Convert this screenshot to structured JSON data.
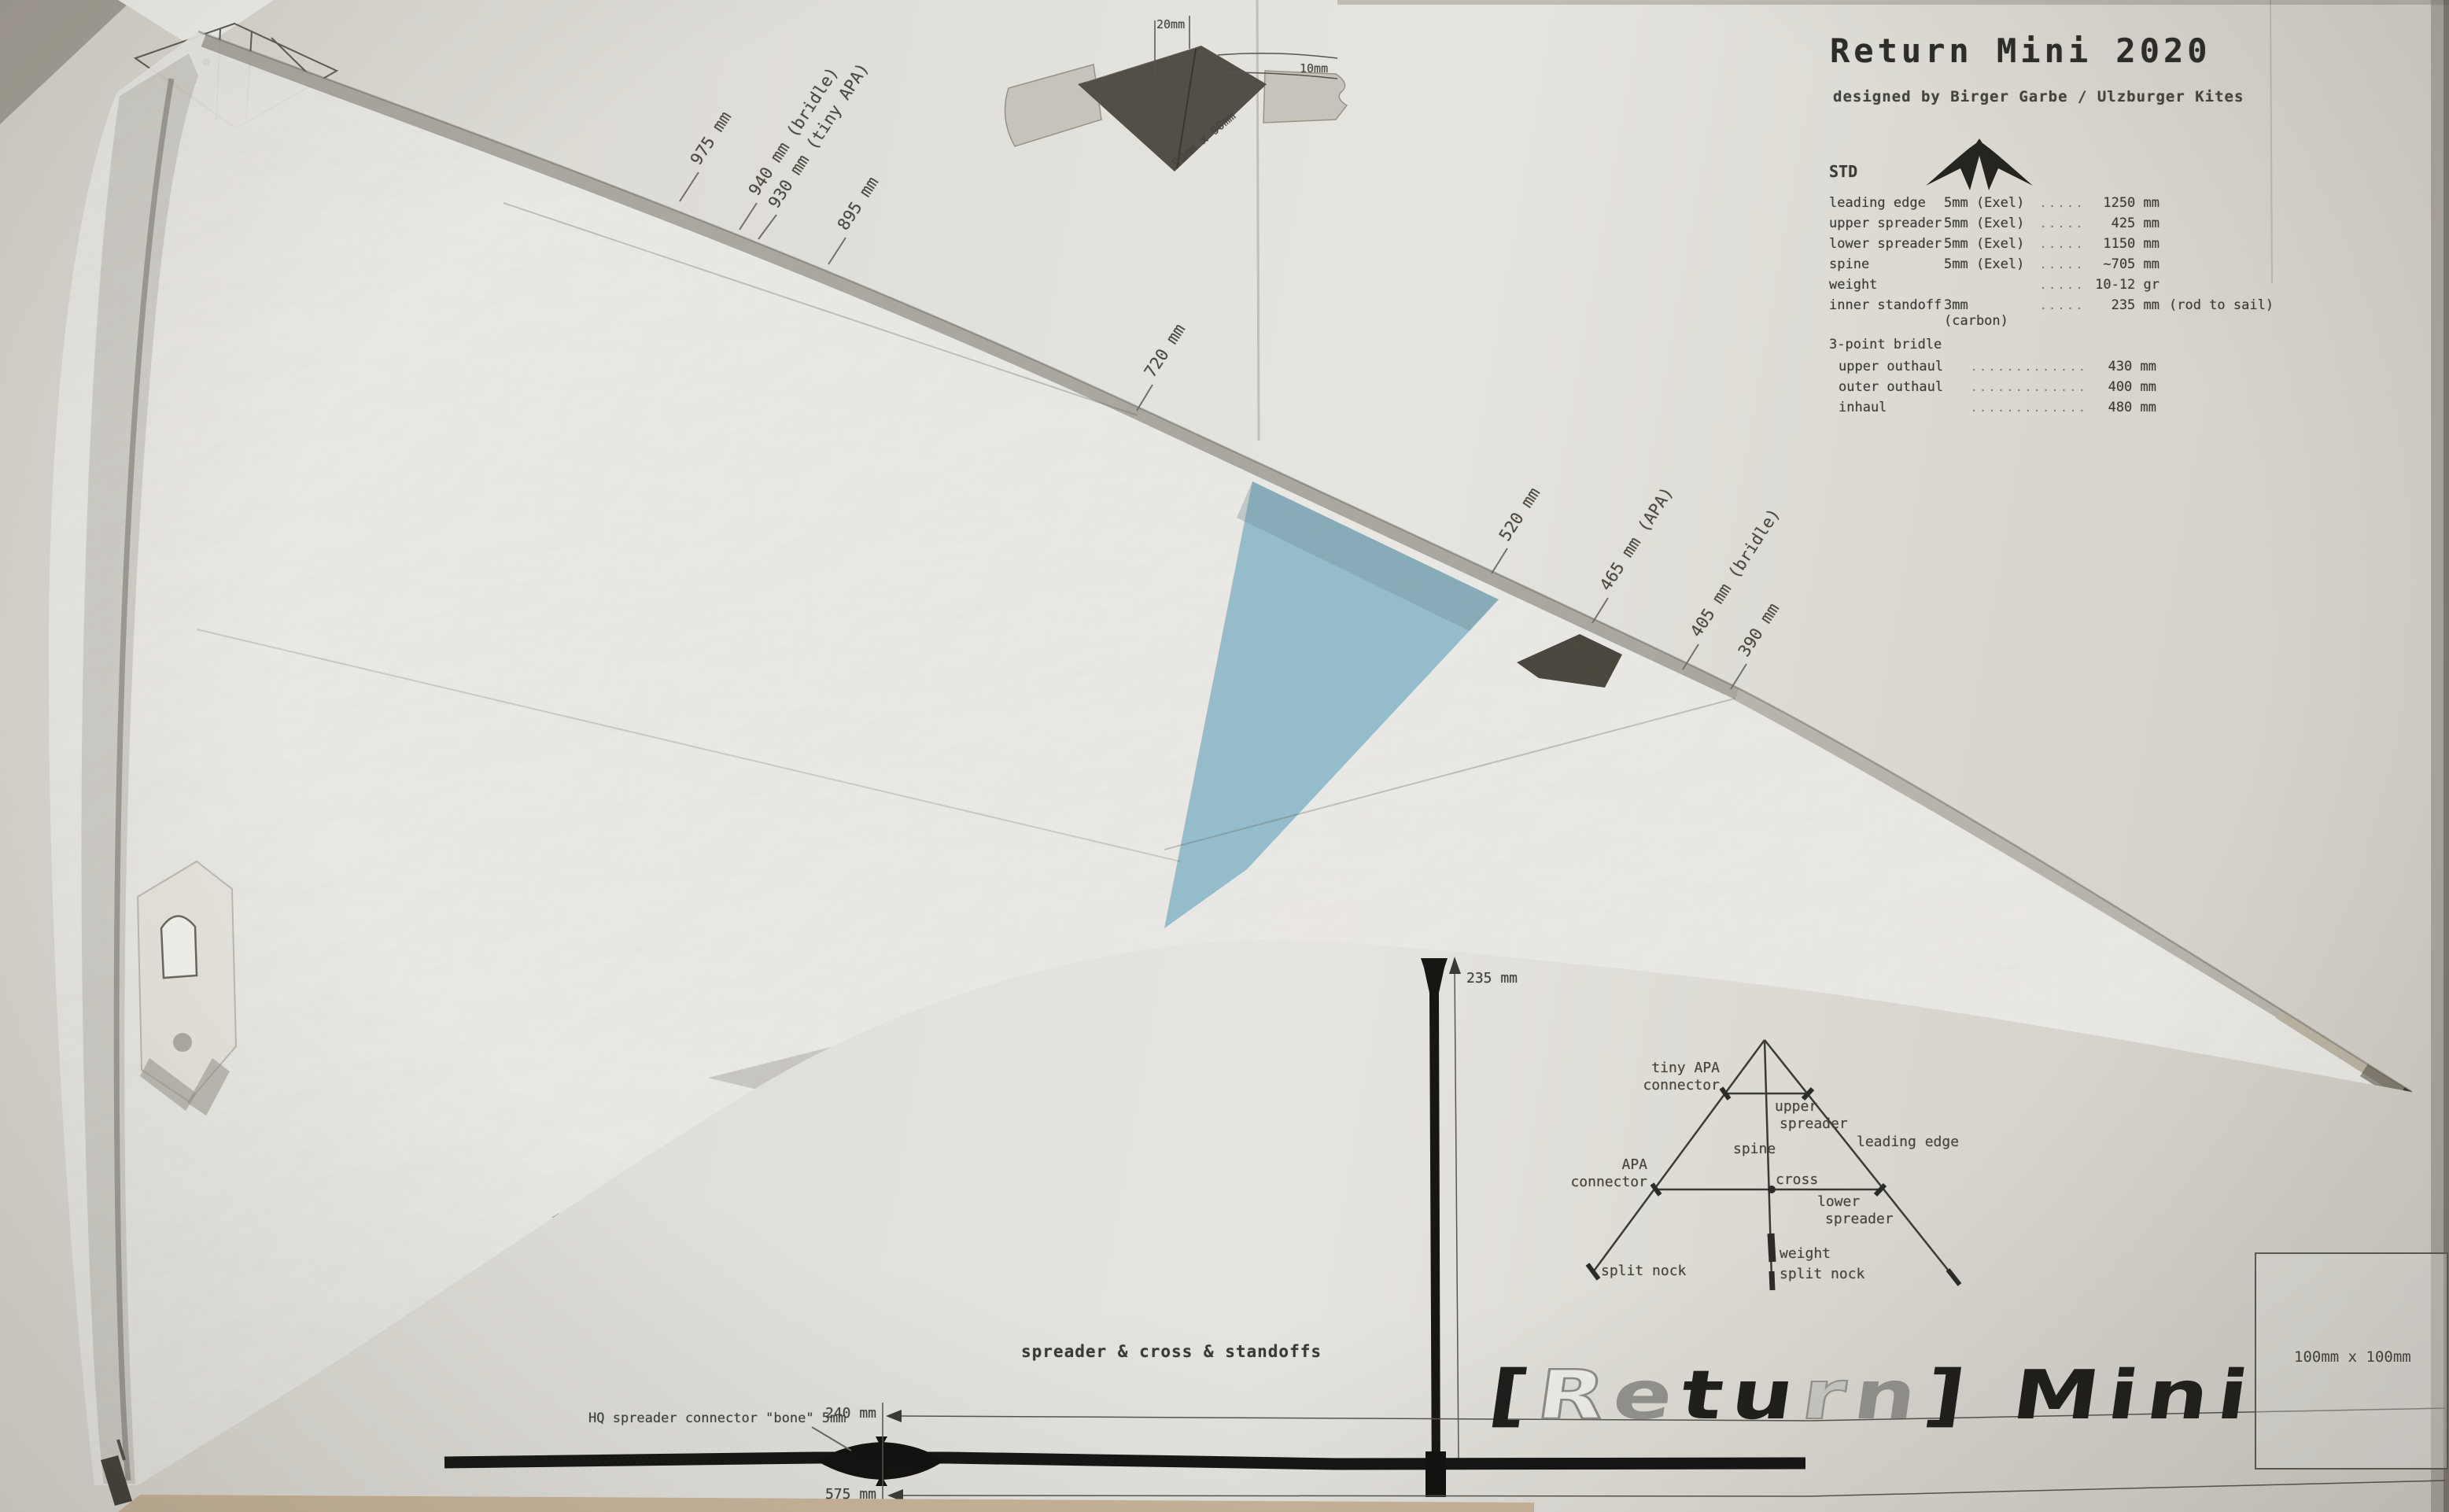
{
  "header": {
    "title": "Return Mini 2020",
    "subtitle": "designed by Birger Garbe / Ulzburger Kites"
  },
  "specs": {
    "variant": "STD",
    "rows": [
      {
        "label": "leading edge",
        "size": "5mm (Exel)",
        "dots": "..........",
        "value": "1250 mm",
        "note": ""
      },
      {
        "label": "upper spreader",
        "size": "5mm (Exel)",
        "dots": "..........",
        "value": "425 mm",
        "note": ""
      },
      {
        "label": "lower spreader",
        "size": "5mm (Exel)",
        "dots": "..........",
        "value": "1150 mm",
        "note": ""
      },
      {
        "label": "spine",
        "size": "5mm (Exel)",
        "dots": "..........",
        "value": "~705 mm",
        "note": ""
      },
      {
        "label": "weight",
        "size": "",
        "dots": "....................",
        "value": "10-12 gr",
        "note": ""
      },
      {
        "label": "inner standoff",
        "size": "3mm (carbon)",
        "dots": "........",
        "value": "235 mm",
        "note": "(rod to sail)"
      }
    ],
    "bridle": {
      "title": "3-point bridle",
      "rows": [
        {
          "label": "upper outhaul",
          "dots": "......................",
          "value": "430 mm"
        },
        {
          "label": "outer outhaul",
          "dots": "......................",
          "value": "400 mm"
        },
        {
          "label": "inhaul",
          "dots": "......................",
          "value": "480 mm"
        }
      ]
    }
  },
  "nose_detail": {
    "dim_top": "20mm",
    "dim_right": "10mm",
    "patch": "90mm x 90mm"
  },
  "callouts": [
    "975 mm",
    "940 mm (bridle)",
    "930 mm (tiny APA)",
    "895 mm",
    "720 mm",
    "520 mm",
    "465 mm (APA)",
    "405 mm (bridle)",
    "390 mm"
  ],
  "frame_diagram": {
    "tiny_apa_line1": "tiny APA",
    "tiny_apa_line2": "connector",
    "upper_line1": "upper",
    "upper_line2": "spreader",
    "leading_edge": "leading edge",
    "spine": "spine",
    "apa_line1": "APA",
    "apa_line2": "connector",
    "cross": "cross",
    "lower_line1": "lower",
    "lower_line2": "spreader",
    "weight": "weight",
    "split_nock_left": "split nock",
    "split_nock_bottom": "split nock"
  },
  "standoff": {
    "dim": "235 mm"
  },
  "spreader_drawing": {
    "caption": "spreader & cross & standoffs",
    "connector_label": "HQ spreader connector \"bone\" 5mm",
    "dim_upper": "240 mm",
    "dim_lower": "575 mm"
  },
  "logo": {
    "l0": "[",
    "l1": "R",
    "l2": "e",
    "l3": "t",
    "l4": "u",
    "l5": "r",
    "l6": "n",
    "l7": "]",
    "word": " Mini"
  },
  "scale_box": {
    "label": "100mm x 100mm"
  },
  "colors": {
    "paper": "#dedbd4",
    "sail": "#eae8e3",
    "blue_panel": "#7fb2c4",
    "ink": "#3c3a35",
    "rod_black": "#141413"
  }
}
